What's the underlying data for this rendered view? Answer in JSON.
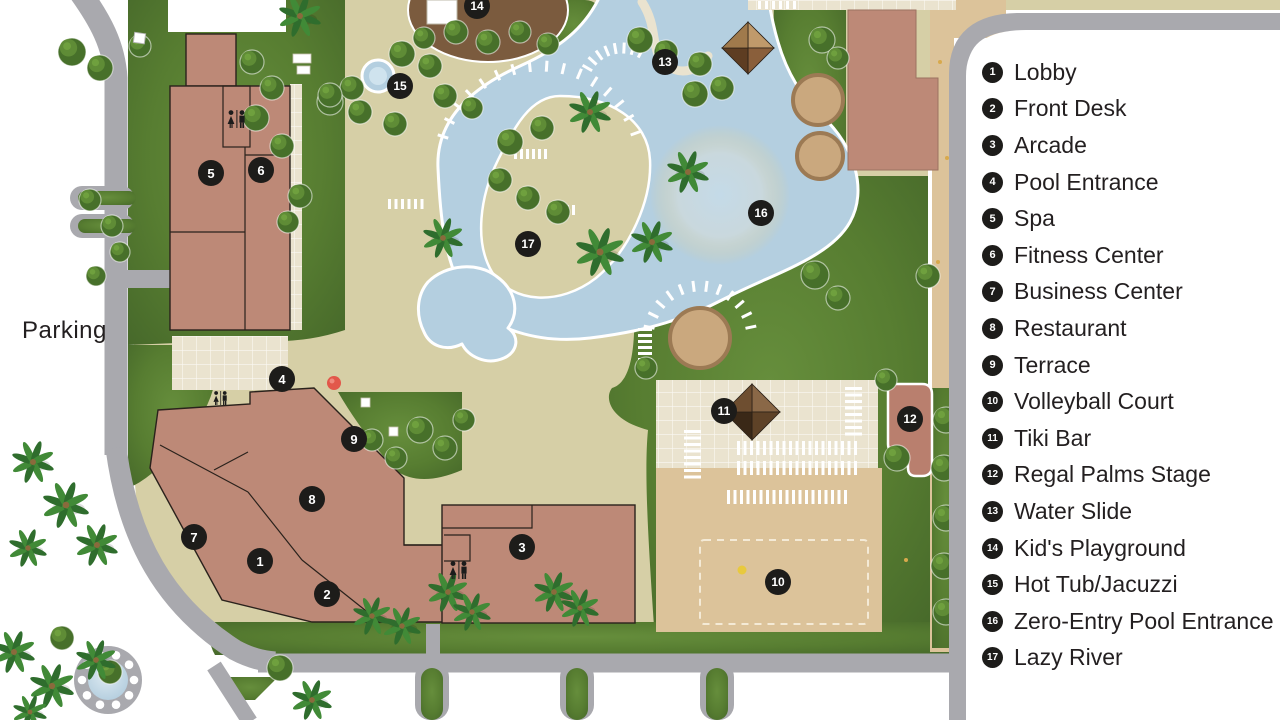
{
  "colors": {
    "deck": "#d6cfa6",
    "tile": "#eae3cf",
    "grass": "#577d31",
    "grass_dark": "#46682a",
    "grass_light": "#668e3c",
    "road": "#a9a9ae",
    "water": "#b4cfe0",
    "water_light": "#cfe3ee",
    "sand": "#dcc39a",
    "building": "#bd8977",
    "building_outline": "#2a221c",
    "stage": "#b97f6e",
    "playground": "#7b5b3e",
    "marker_bg": "#1d1c1a",
    "marker_text": "#ffffff",
    "text": "#231f20",
    "legend_bg": "#ffffff",
    "ball_red": "#e2574a",
    "ball_yellow": "#e8c93e",
    "palm_dark": "#2f6d2d",
    "palm_light": "#418a37",
    "bush": "#47702a",
    "bush_light": "#5f8c36",
    "planter": "#caa87e",
    "planter_ring": "#9c7a54",
    "tiki_roof": [
      "#8a6847",
      "#5e4227",
      "#3a2817",
      "#6e4e30"
    ],
    "gazebo_roof": [
      "#c09a6b",
      "#8a5f3b",
      "#5e3d22",
      "#a07a4c"
    ]
  },
  "legend": {
    "items": [
      {
        "num": "1",
        "label": "Lobby"
      },
      {
        "num": "2",
        "label": "Front Desk"
      },
      {
        "num": "3",
        "label": "Arcade"
      },
      {
        "num": "4",
        "label": "Pool Entrance"
      },
      {
        "num": "5",
        "label": "Spa"
      },
      {
        "num": "6",
        "label": "Fitness Center"
      },
      {
        "num": "7",
        "label": "Business Center"
      },
      {
        "num": "8",
        "label": "Restaurant"
      },
      {
        "num": "9",
        "label": "Terrace"
      },
      {
        "num": "10",
        "label": "Volleyball Court"
      },
      {
        "num": "11",
        "label": "Tiki Bar"
      },
      {
        "num": "12",
        "label": "Regal Palms Stage"
      },
      {
        "num": "13",
        "label": "Water Slide"
      },
      {
        "num": "14",
        "label": "Kid's Playground"
      },
      {
        "num": "15",
        "label": "Hot Tub/Jacuzzi"
      },
      {
        "num": "16",
        "label": "Zero-Entry Pool Entrance"
      },
      {
        "num": "17",
        "label": "Lazy River"
      }
    ]
  },
  "map": {
    "parking_label": "Parking",
    "markers": [
      {
        "num": "1",
        "x": 260,
        "y": 561
      },
      {
        "num": "2",
        "x": 327,
        "y": 594
      },
      {
        "num": "3",
        "x": 522,
        "y": 547
      },
      {
        "num": "4",
        "x": 282,
        "y": 379
      },
      {
        "num": "5",
        "x": 211,
        "y": 173
      },
      {
        "num": "6",
        "x": 261,
        "y": 170
      },
      {
        "num": "7",
        "x": 194,
        "y": 537
      },
      {
        "num": "8",
        "x": 312,
        "y": 499
      },
      {
        "num": "9",
        "x": 354,
        "y": 439
      },
      {
        "num": "10",
        "x": 778,
        "y": 582
      },
      {
        "num": "11",
        "x": 724,
        "y": 411
      },
      {
        "num": "12",
        "x": 910,
        "y": 419
      },
      {
        "num": "13",
        "x": 665,
        "y": 62
      },
      {
        "num": "14",
        "x": 477,
        "y": 6
      },
      {
        "num": "15",
        "x": 400,
        "y": 86
      },
      {
        "num": "16",
        "x": 761,
        "y": 213
      },
      {
        "num": "17",
        "x": 528,
        "y": 244
      }
    ],
    "restroom_icons": [
      {
        "x": 227,
        "y": 110,
        "s": 1.0
      },
      {
        "x": 213,
        "y": 391,
        "s": 0.78
      },
      {
        "x": 449,
        "y": 561,
        "s": 1.0
      }
    ],
    "decor": {
      "palms": [
        [
          300,
          16,
          1
        ],
        [
          443,
          238,
          0.95
        ],
        [
          590,
          112,
          1
        ],
        [
          600,
          252,
          1.15
        ],
        [
          652,
          242,
          1
        ],
        [
          688,
          172,
          1
        ],
        [
          33,
          462,
          1
        ],
        [
          66,
          505,
          1.1
        ],
        [
          28,
          548,
          0.9
        ],
        [
          97,
          545,
          1
        ],
        [
          372,
          616,
          0.9
        ],
        [
          402,
          626,
          0.9
        ],
        [
          448,
          592,
          0.95
        ],
        [
          472,
          612,
          0.9
        ],
        [
          554,
          592,
          0.95
        ],
        [
          580,
          608,
          0.9
        ],
        [
          14,
          652,
          1
        ],
        [
          52,
          686,
          1.05
        ],
        [
          96,
          660,
          0.95
        ],
        [
          312,
          700,
          0.95
        ],
        [
          30,
          712,
          0.8
        ]
      ],
      "bushes": [
        [
          72,
          52,
          14
        ],
        [
          100,
          68,
          13
        ],
        [
          140,
          46,
          11
        ],
        [
          252,
          62,
          12
        ],
        [
          272,
          88,
          12
        ],
        [
          256,
          118,
          13
        ],
        [
          282,
          146,
          12
        ],
        [
          300,
          196,
          12
        ],
        [
          288,
          222,
          11
        ],
        [
          90,
          200,
          11
        ],
        [
          112,
          226,
          11
        ],
        [
          120,
          252,
          10
        ],
        [
          96,
          276,
          10
        ],
        [
          330,
          102,
          13
        ],
        [
          352,
          88,
          12
        ],
        [
          402,
          54,
          13
        ],
        [
          430,
          66,
          12
        ],
        [
          424,
          38,
          11
        ],
        [
          330,
          95,
          12
        ],
        [
          360,
          112,
          12
        ],
        [
          395,
          124,
          12
        ],
        [
          445,
          96,
          12
        ],
        [
          472,
          108,
          11
        ],
        [
          456,
          32,
          12
        ],
        [
          488,
          42,
          12
        ],
        [
          520,
          32,
          11
        ],
        [
          548,
          44,
          11
        ],
        [
          510,
          142,
          13
        ],
        [
          542,
          128,
          12
        ],
        [
          500,
          180,
          12
        ],
        [
          528,
          198,
          12
        ],
        [
          558,
          212,
          12
        ],
        [
          640,
          40,
          13
        ],
        [
          666,
          52,
          12
        ],
        [
          700,
          64,
          12
        ],
        [
          695,
          94,
          13
        ],
        [
          722,
          88,
          12
        ],
        [
          822,
          40,
          13
        ],
        [
          838,
          58,
          11
        ],
        [
          815,
          275,
          14
        ],
        [
          838,
          298,
          12
        ],
        [
          928,
          276,
          12
        ],
        [
          646,
          368,
          11
        ],
        [
          420,
          430,
          13
        ],
        [
          445,
          448,
          12
        ],
        [
          464,
          420,
          11
        ],
        [
          372,
          440,
          11
        ],
        [
          396,
          458,
          11
        ],
        [
          886,
          380,
          11
        ],
        [
          897,
          458,
          13
        ],
        [
          946,
          420,
          13
        ],
        [
          944,
          468,
          13
        ],
        [
          946,
          518,
          13
        ],
        [
          944,
          566,
          13
        ],
        [
          946,
          612,
          13
        ],
        [
          280,
          668,
          13
        ],
        [
          62,
          638,
          12
        ],
        [
          110,
          672,
          12
        ]
      ],
      "chair_rows": [
        [
          737,
          441,
          19,
          6.5,
          14
        ],
        [
          737,
          461,
          19,
          6.5,
          14
        ],
        [
          727,
          490,
          19,
          6.5,
          14
        ],
        [
          514,
          149,
          6,
          6,
          10
        ],
        [
          388,
          199,
          6,
          6.5,
          10
        ],
        [
          758,
          1,
          6,
          7,
          8
        ],
        [
          548,
          205,
          5,
          6,
          10
        ]
      ],
      "chair_stacks": [
        [
          684,
          430,
          8,
          6.5,
          17
        ],
        [
          845,
          387,
          8,
          6.5,
          17
        ],
        [
          638,
          328,
          7,
          6,
          14
        ]
      ],
      "chair_fans": [
        [
          540,
          168,
          102,
          -162,
          -20,
          16
        ],
        [
          700,
          338,
          52,
          -168,
          -12,
          12
        ],
        [
          622,
          88,
          40,
          -150,
          -62,
          8
        ]
      ],
      "planters": [
        [
          818,
          100,
          25
        ],
        [
          820,
          156,
          23
        ],
        [
          700,
          338,
          30
        ]
      ],
      "tables": [
        [
          293,
          54,
          18,
          9
        ],
        [
          297,
          66,
          13,
          8
        ],
        [
          361,
          398,
          9,
          9
        ],
        [
          389,
          427,
          9,
          9
        ]
      ],
      "sand_dots": [
        [
          940,
          62
        ],
        [
          947,
          158
        ],
        [
          938,
          262
        ],
        [
          950,
          472
        ],
        [
          944,
          556
        ],
        [
          846,
          440
        ],
        [
          906,
          560
        ],
        [
          700,
          500
        ],
        [
          800,
          610
        ]
      ]
    }
  }
}
